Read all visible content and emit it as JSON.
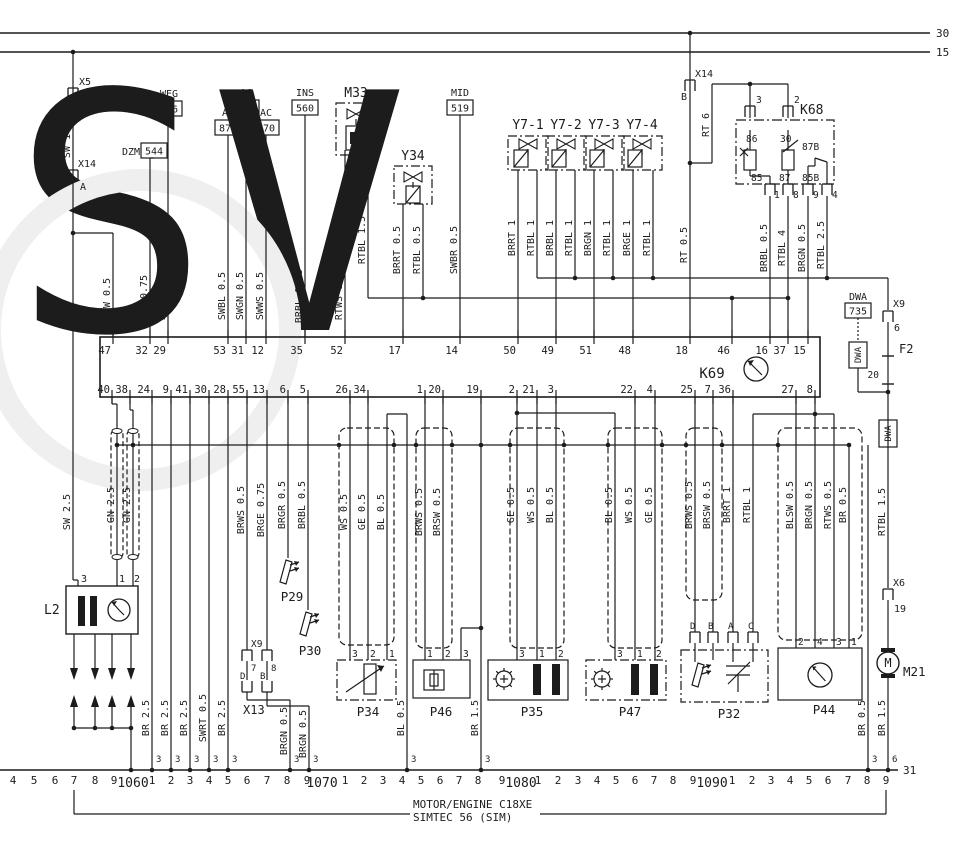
{
  "caption": {
    "line1": "MOTOR/ENGINE C18XE",
    "line2": "SIMTEC 56 (SIM)"
  },
  "power_buses": [
    {
      "label": "30",
      "y": 33
    },
    {
      "label": "15",
      "y": 52
    }
  ],
  "ground_bus": {
    "label": "31"
  },
  "ecu": {
    "name": "K69",
    "top_pins": [
      {
        "n": "47",
        "x": 113
      },
      {
        "n": "32",
        "x": 150
      },
      {
        "n": "29",
        "x": 168
      },
      {
        "n": "53",
        "x": 228
      },
      {
        "n": "31",
        "x": 246
      },
      {
        "n": "12",
        "x": 266
      },
      {
        "n": "35",
        "x": 305
      },
      {
        "n": "52",
        "x": 345
      },
      {
        "n": "17",
        "x": 403
      },
      {
        "n": "14",
        "x": 460
      },
      {
        "n": "50",
        "x": 518
      },
      {
        "n": "49",
        "x": 556
      },
      {
        "n": "51",
        "x": 594
      },
      {
        "n": "48",
        "x": 633
      },
      {
        "n": "18",
        "x": 690
      },
      {
        "n": "46",
        "x": 732
      },
      {
        "n": "16",
        "x": 770
      },
      {
        "n": "37",
        "x": 788
      },
      {
        "n": "15",
        "x": 808
      }
    ],
    "bottom_pins": [
      {
        "n": "40",
        "x": 112
      },
      {
        "n": "38",
        "x": 130
      },
      {
        "n": "24",
        "x": 152
      },
      {
        "n": "9",
        "x": 171
      },
      {
        "n": "41",
        "x": 190
      },
      {
        "n": "30",
        "x": 209
      },
      {
        "n": "28",
        "x": 228
      },
      {
        "n": "55",
        "x": 247
      },
      {
        "n": "13",
        "x": 267
      },
      {
        "n": "6",
        "x": 288
      },
      {
        "n": "5",
        "x": 308
      },
      {
        "n": "26",
        "x": 350
      },
      {
        "n": "34",
        "x": 368
      },
      {
        "n": "1",
        "x": 425
      },
      {
        "n": "20",
        "x": 443
      },
      {
        "n": "19",
        "x": 481
      },
      {
        "n": "2",
        "x": 517
      },
      {
        "n": "21",
        "x": 537
      },
      {
        "n": "3",
        "x": 556
      },
      {
        "n": "22",
        "x": 635
      },
      {
        "n": "4",
        "x": 655
      },
      {
        "n": "25",
        "x": 695
      },
      {
        "n": "7",
        "x": 713
      },
      {
        "n": "36",
        "x": 733
      },
      {
        "n": "27",
        "x": 796
      },
      {
        "n": "8",
        "x": 815
      }
    ]
  },
  "parts": {
    "X5": {
      "label": "X5",
      "pin": "9"
    },
    "X14A": {
      "label": "X14",
      "pin": "A"
    },
    "X14B": {
      "label": "X14",
      "pin": "B"
    },
    "DZM": {
      "label": "DZM",
      "code": "544"
    },
    "WEG": {
      "label": "WEG",
      "code": "556"
    },
    "AC874": {
      "label": "AC",
      "code": "874"
    },
    "AC872": {
      "label": "AC",
      "code": "872"
    },
    "AC870": {
      "label": "AC",
      "code": "870"
    },
    "INS": {
      "label": "INS",
      "code": "560"
    },
    "MID": {
      "label": "MID",
      "code": "519"
    },
    "M33": {
      "label": "M33"
    },
    "Y34": {
      "label": "Y34"
    },
    "Y7": [
      {
        "label": "Y7-1"
      },
      {
        "label": "Y7-2"
      },
      {
        "label": "Y7-3"
      },
      {
        "label": "Y7-4"
      }
    ],
    "K68": {
      "label": "K68",
      "top_conn": [
        "3",
        "2"
      ],
      "top_terms": [
        "86",
        "30",
        "87B"
      ],
      "bot_terms": [
        "85",
        "87",
        "85B"
      ],
      "bot_conn": [
        "1",
        "8",
        "9",
        "4"
      ]
    },
    "DWA": {
      "label": "DWA",
      "code": "735",
      "tag": "DWA"
    },
    "X96": {
      "label": "X9",
      "pin": "6"
    },
    "F2": {
      "label": "F2",
      "value": "20"
    },
    "L2": {
      "label": "L2",
      "pins": [
        "3",
        "1",
        "2"
      ]
    },
    "P29": {
      "label": "P29"
    },
    "P30": {
      "label": "P30"
    },
    "X978": {
      "label": "X9",
      "pins": [
        "7",
        "8"
      ]
    },
    "X13": {
      "label": "X13",
      "pins": [
        "D",
        "B"
      ]
    },
    "P34": {
      "label": "P34",
      "pins": [
        "3",
        "2",
        "1"
      ]
    },
    "P46": {
      "label": "P46",
      "pins": [
        "1",
        "2",
        "3"
      ]
    },
    "P35": {
      "label": "P35",
      "pins": [
        "3",
        "1",
        "2"
      ]
    },
    "P47": {
      "label": "P47",
      "pins": [
        "3",
        "1",
        "2"
      ]
    },
    "P32": {
      "label": "P32",
      "pins": [
        "D",
        "B",
        "A",
        "C"
      ]
    },
    "P44": {
      "label": "P44",
      "pins": [
        "2",
        "4",
        "3",
        "1"
      ]
    },
    "X6": {
      "label": "X6",
      "pin": "19"
    },
    "M21": {
      "label": "M21",
      "symbol": "M"
    }
  },
  "wire_labels": [
    {
      "t": "SW 1.5",
      "x": 73,
      "y": 140
    },
    {
      "t": "SW 0.5",
      "x": 113,
      "y": 296
    },
    {
      "t": "GN 0.75",
      "x": 150,
      "y": 296
    },
    {
      "t": "BLRT 0.5",
      "x": 168,
      "y": 296
    },
    {
      "t": "SWBL 0.5",
      "x": 228,
      "y": 296
    },
    {
      "t": "SWGN 0.5",
      "x": 246,
      "y": 296
    },
    {
      "t": "SWWS 0.5",
      "x": 266,
      "y": 296
    },
    {
      "t": "BRBL 0.75",
      "x": 305,
      "y": 296
    },
    {
      "t": "RTWS 1.5",
      "x": 345,
      "y": 296
    },
    {
      "t": "RTBL 1.5",
      "x": 368,
      "y": 240
    },
    {
      "t": "BRRT 0.5",
      "x": 403,
      "y": 250
    },
    {
      "t": "RTBL 0.5",
      "x": 423,
      "y": 250
    },
    {
      "t": "SWBR 0.5",
      "x": 460,
      "y": 250
    },
    {
      "t": "BRRT 1",
      "x": 518,
      "y": 238
    },
    {
      "t": "RTBL 1",
      "x": 537,
      "y": 238
    },
    {
      "t": "BRBL 1",
      "x": 556,
      "y": 238
    },
    {
      "t": "RTBL 1",
      "x": 575,
      "y": 238
    },
    {
      "t": "BRGN 1",
      "x": 594,
      "y": 238
    },
    {
      "t": "RTBL 1",
      "x": 613,
      "y": 238
    },
    {
      "t": "BRGE 1",
      "x": 633,
      "y": 238
    },
    {
      "t": "RTBL 1",
      "x": 653,
      "y": 238
    },
    {
      "t": "RT 6",
      "x": 712,
      "y": 125
    },
    {
      "t": "RT 0.5",
      "x": 690,
      "y": 245
    },
    {
      "t": "BRBL 0.5",
      "x": 770,
      "y": 248
    },
    {
      "t": "RTBL 4",
      "x": 788,
      "y": 248
    },
    {
      "t": "BRGN 0.5",
      "x": 808,
      "y": 248
    },
    {
      "t": "RTBL 2.5",
      "x": 827,
      "y": 245
    },
    {
      "t": "SW 2.5",
      "x": 73,
      "y": 512
    },
    {
      "t": "GN 2.5",
      "x": 117,
      "y": 505
    },
    {
      "t": "GN 2.5",
      "x": 133,
      "y": 505
    },
    {
      "t": "BR 2.5",
      "x": 152,
      "y": 718
    },
    {
      "t": "BR 2.5",
      "x": 171,
      "y": 718
    },
    {
      "t": "BR 2.5",
      "x": 190,
      "y": 718
    },
    {
      "t": "SWRT 0.5",
      "x": 209,
      "y": 718
    },
    {
      "t": "BR 2.5",
      "x": 228,
      "y": 718
    },
    {
      "t": "BRWS 0.5",
      "x": 247,
      "y": 510
    },
    {
      "t": "BRGE 0.75",
      "x": 267,
      "y": 510
    },
    {
      "t": "BRGR 0.5",
      "x": 288,
      "y": 505
    },
    {
      "t": "BRBL 0.5",
      "x": 308,
      "y": 505
    },
    {
      "t": "BRGN 0.5",
      "x": 290,
      "y": 731
    },
    {
      "t": "BRGN 0.5",
      "x": 309,
      "y": 734
    },
    {
      "t": "WS 0.5",
      "x": 350,
      "y": 512
    },
    {
      "t": "GE 0.5",
      "x": 368,
      "y": 512
    },
    {
      "t": "BL 0.5",
      "x": 387,
      "y": 512
    },
    {
      "t": "BL 0.5",
      "x": 407,
      "y": 718
    },
    {
      "t": "BRWS 0.5",
      "x": 425,
      "y": 512
    },
    {
      "t": "BRSW 0.5",
      "x": 443,
      "y": 512
    },
    {
      "t": "BR 1.5",
      "x": 481,
      "y": 718
    },
    {
      "t": "GE 0.5",
      "x": 517,
      "y": 505
    },
    {
      "t": "WS 0.5",
      "x": 537,
      "y": 505
    },
    {
      "t": "BL 0.5",
      "x": 556,
      "y": 505
    },
    {
      "t": "BL 0.5",
      "x": 615,
      "y": 505
    },
    {
      "t": "WS 0.5",
      "x": 635,
      "y": 505
    },
    {
      "t": "GE 0.5",
      "x": 655,
      "y": 505
    },
    {
      "t": "BRWS 0.5",
      "x": 695,
      "y": 505
    },
    {
      "t": "BRSW 0.5",
      "x": 713,
      "y": 505
    },
    {
      "t": "BRRT 1",
      "x": 733,
      "y": 505
    },
    {
      "t": "RTBL 1",
      "x": 753,
      "y": 505
    },
    {
      "t": "BLSW 0.5",
      "x": 796,
      "y": 505
    },
    {
      "t": "BRGN 0.5",
      "x": 815,
      "y": 505
    },
    {
      "t": "RTWS 0.5",
      "x": 834,
      "y": 505
    },
    {
      "t": "BR 0.5",
      "x": 849,
      "y": 505
    },
    {
      "t": "RTBL 1.5",
      "x": 888,
      "y": 512
    },
    {
      "t": "BR 0.5",
      "x": 868,
      "y": 718
    },
    {
      "t": "BR 1.5",
      "x": 888,
      "y": 718
    }
  ],
  "rail": {
    "connections": [
      {
        "x": 152,
        "t": "3"
      },
      {
        "x": 171,
        "t": "3"
      },
      {
        "x": 190,
        "t": "3"
      },
      {
        "x": 209,
        "t": "3"
      },
      {
        "x": 228,
        "t": "3"
      },
      {
        "x": 290,
        "t": "3"
      },
      {
        "x": 309,
        "t": "3"
      },
      {
        "x": 407,
        "t": "3"
      },
      {
        "x": 481,
        "t": "3"
      },
      {
        "x": 868,
        "t": "3"
      },
      {
        "x": 888,
        "t": "6"
      }
    ],
    "scale": [
      {
        "t": "4",
        "x": 13
      },
      {
        "t": "5",
        "x": 34
      },
      {
        "t": "6",
        "x": 55
      },
      {
        "t": "7",
        "x": 74
      },
      {
        "t": "8",
        "x": 95
      },
      {
        "t": "9",
        "x": 114
      },
      {
        "t": "1060",
        "x": 133,
        "big": 1
      },
      {
        "t": "1",
        "x": 152
      },
      {
        "t": "2",
        "x": 171
      },
      {
        "t": "3",
        "x": 190
      },
      {
        "t": "4",
        "x": 209
      },
      {
        "t": "5",
        "x": 228
      },
      {
        "t": "6",
        "x": 247
      },
      {
        "t": "7",
        "x": 267
      },
      {
        "t": "8",
        "x": 287
      },
      {
        "t": "9",
        "x": 307
      },
      {
        "t": "1070",
        "x": 322,
        "big": 1
      },
      {
        "t": "1",
        "x": 345
      },
      {
        "t": "2",
        "x": 364
      },
      {
        "t": "3",
        "x": 383
      },
      {
        "t": "4",
        "x": 402
      },
      {
        "t": "5",
        "x": 421
      },
      {
        "t": "6",
        "x": 440
      },
      {
        "t": "7",
        "x": 459
      },
      {
        "t": "8",
        "x": 478
      },
      {
        "t": "9",
        "x": 502
      },
      {
        "t": "1080",
        "x": 521,
        "big": 1
      },
      {
        "t": "1",
        "x": 538
      },
      {
        "t": "2",
        "x": 558
      },
      {
        "t": "3",
        "x": 578
      },
      {
        "t": "4",
        "x": 597
      },
      {
        "t": "5",
        "x": 616
      },
      {
        "t": "6",
        "x": 635
      },
      {
        "t": "7",
        "x": 654
      },
      {
        "t": "8",
        "x": 673
      },
      {
        "t": "9",
        "x": 693
      },
      {
        "t": "1090",
        "x": 712,
        "big": 1
      },
      {
        "t": "1",
        "x": 732
      },
      {
        "t": "2",
        "x": 752
      },
      {
        "t": "3",
        "x": 771
      },
      {
        "t": "4",
        "x": 790
      },
      {
        "t": "5",
        "x": 809
      },
      {
        "t": "6",
        "x": 828
      },
      {
        "t": "7",
        "x": 848
      },
      {
        "t": "8",
        "x": 867
      },
      {
        "t": "9",
        "x": 886
      }
    ]
  }
}
